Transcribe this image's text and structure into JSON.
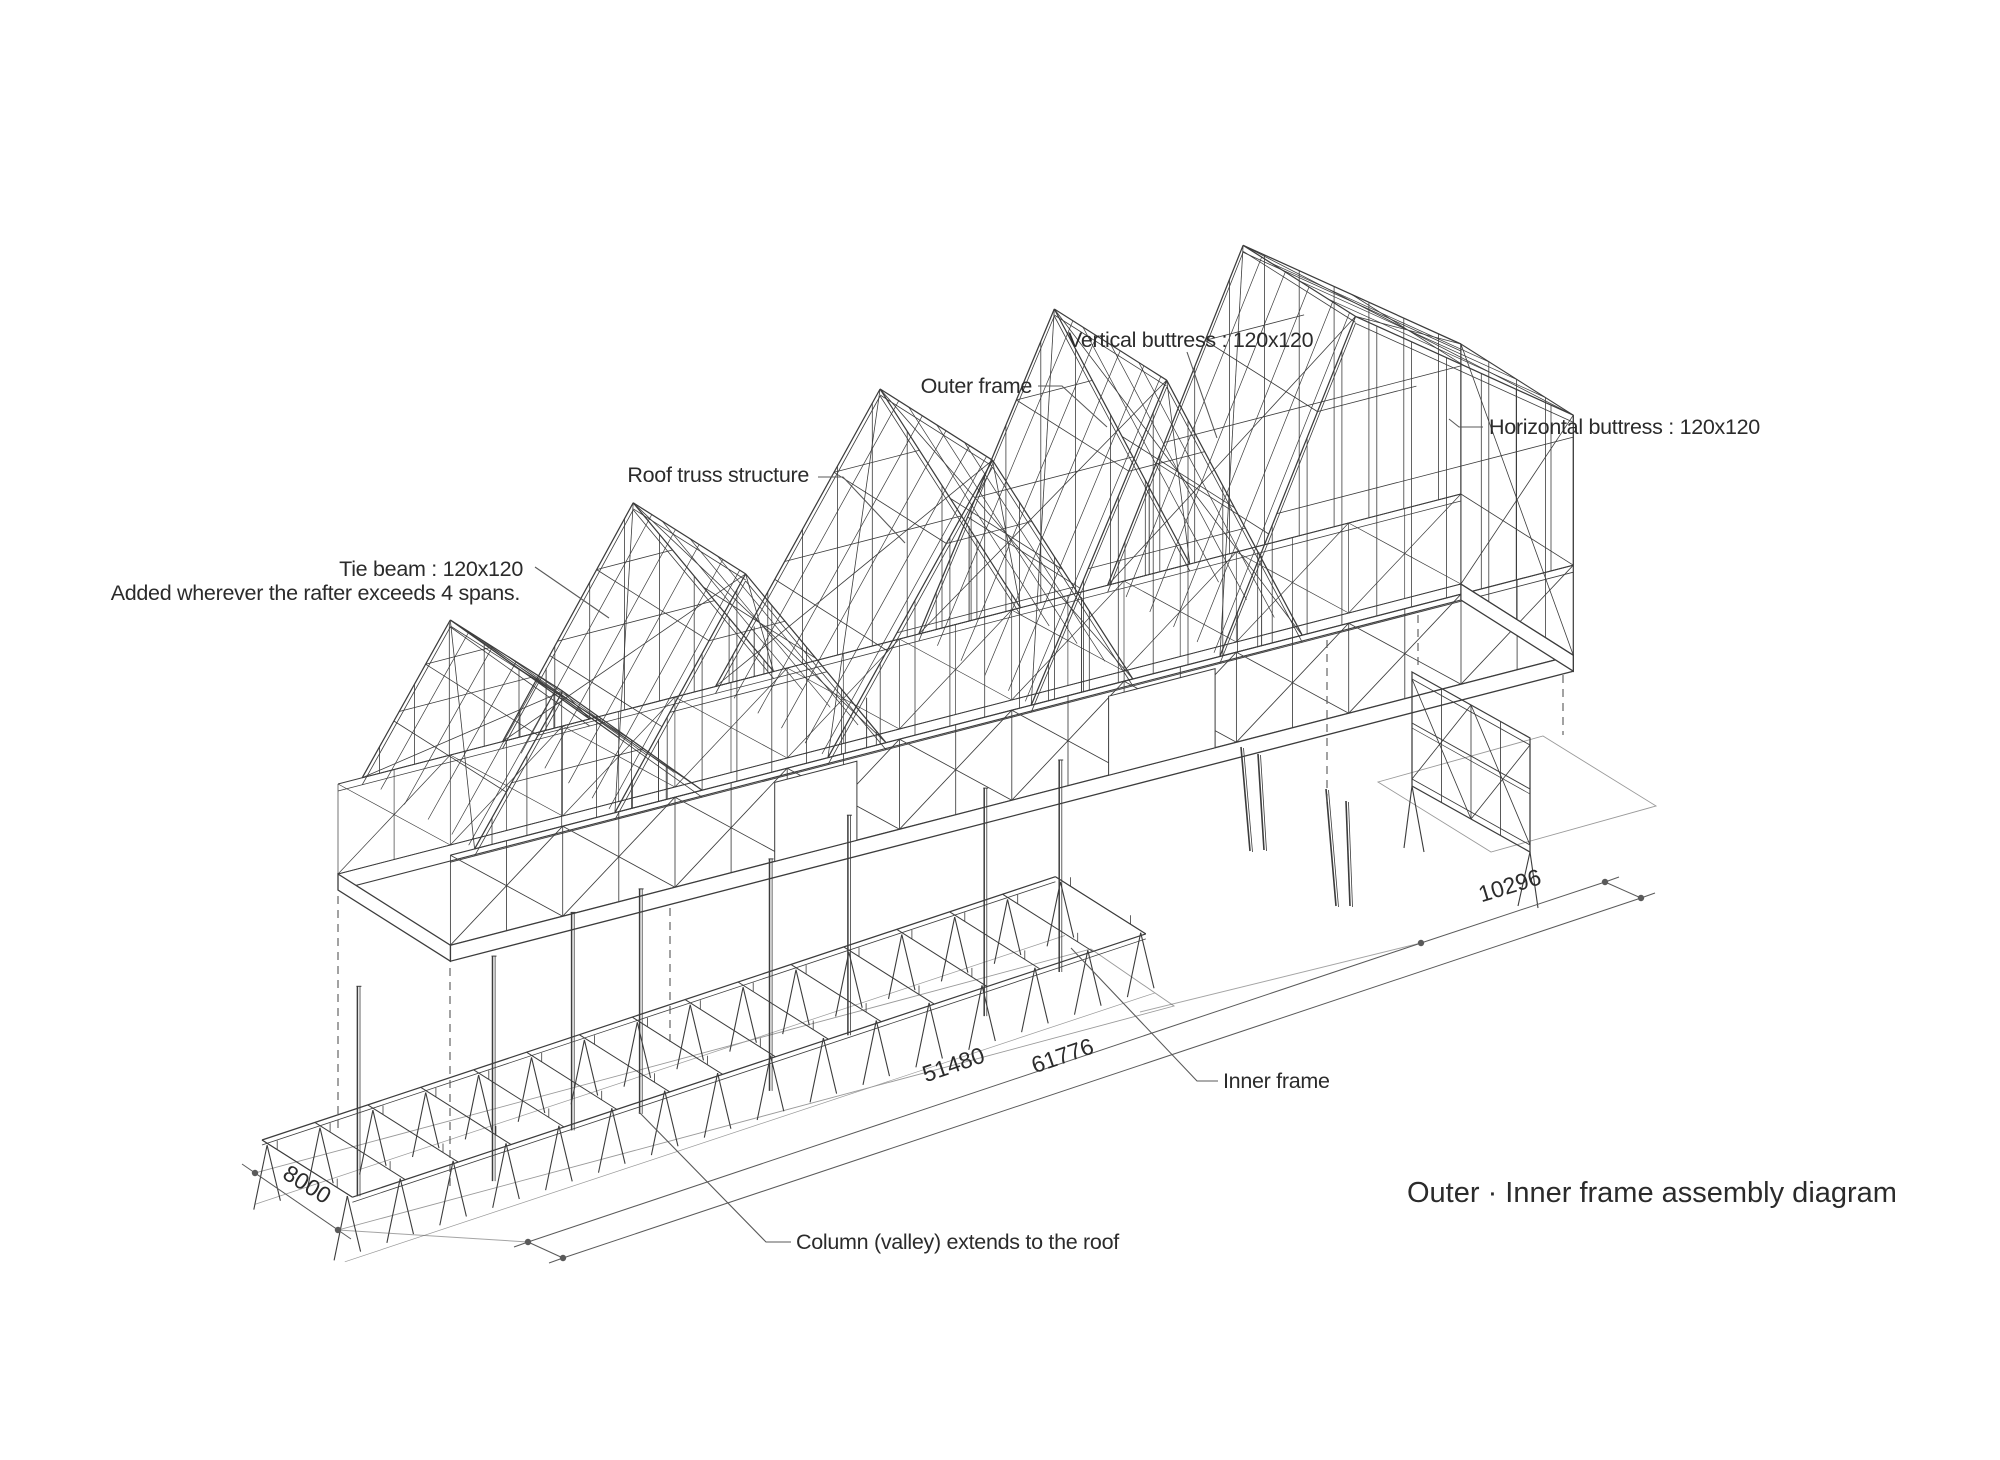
{
  "colors": {
    "background": "#ffffff",
    "ink": "#3c3c3c",
    "annotation": "#5a5a5a",
    "text": "#2b2b2b",
    "ground_line": "#9a9a9a"
  },
  "title": "Outer · Inner frame assembly diagram",
  "labels": {
    "tie_beam_line1": "Tie beam : 120x120",
    "tie_beam_line2": "Added wherever the rafter exceeds 4 spans.",
    "roof_truss": "Roof truss structure",
    "outer_frame": "Outer frame",
    "vertical_buttress": "Vertical buttress : 120x120",
    "horizontal_buttress": "Horizontal buttress : 120x120",
    "inner_frame": "Inner frame",
    "column_valley": "Column (valley) extends to the roof"
  },
  "dimensions": {
    "width": "8000",
    "inner_frame_length": "51480",
    "overall_length": "61776",
    "right_bay_length": "10296"
  }
}
